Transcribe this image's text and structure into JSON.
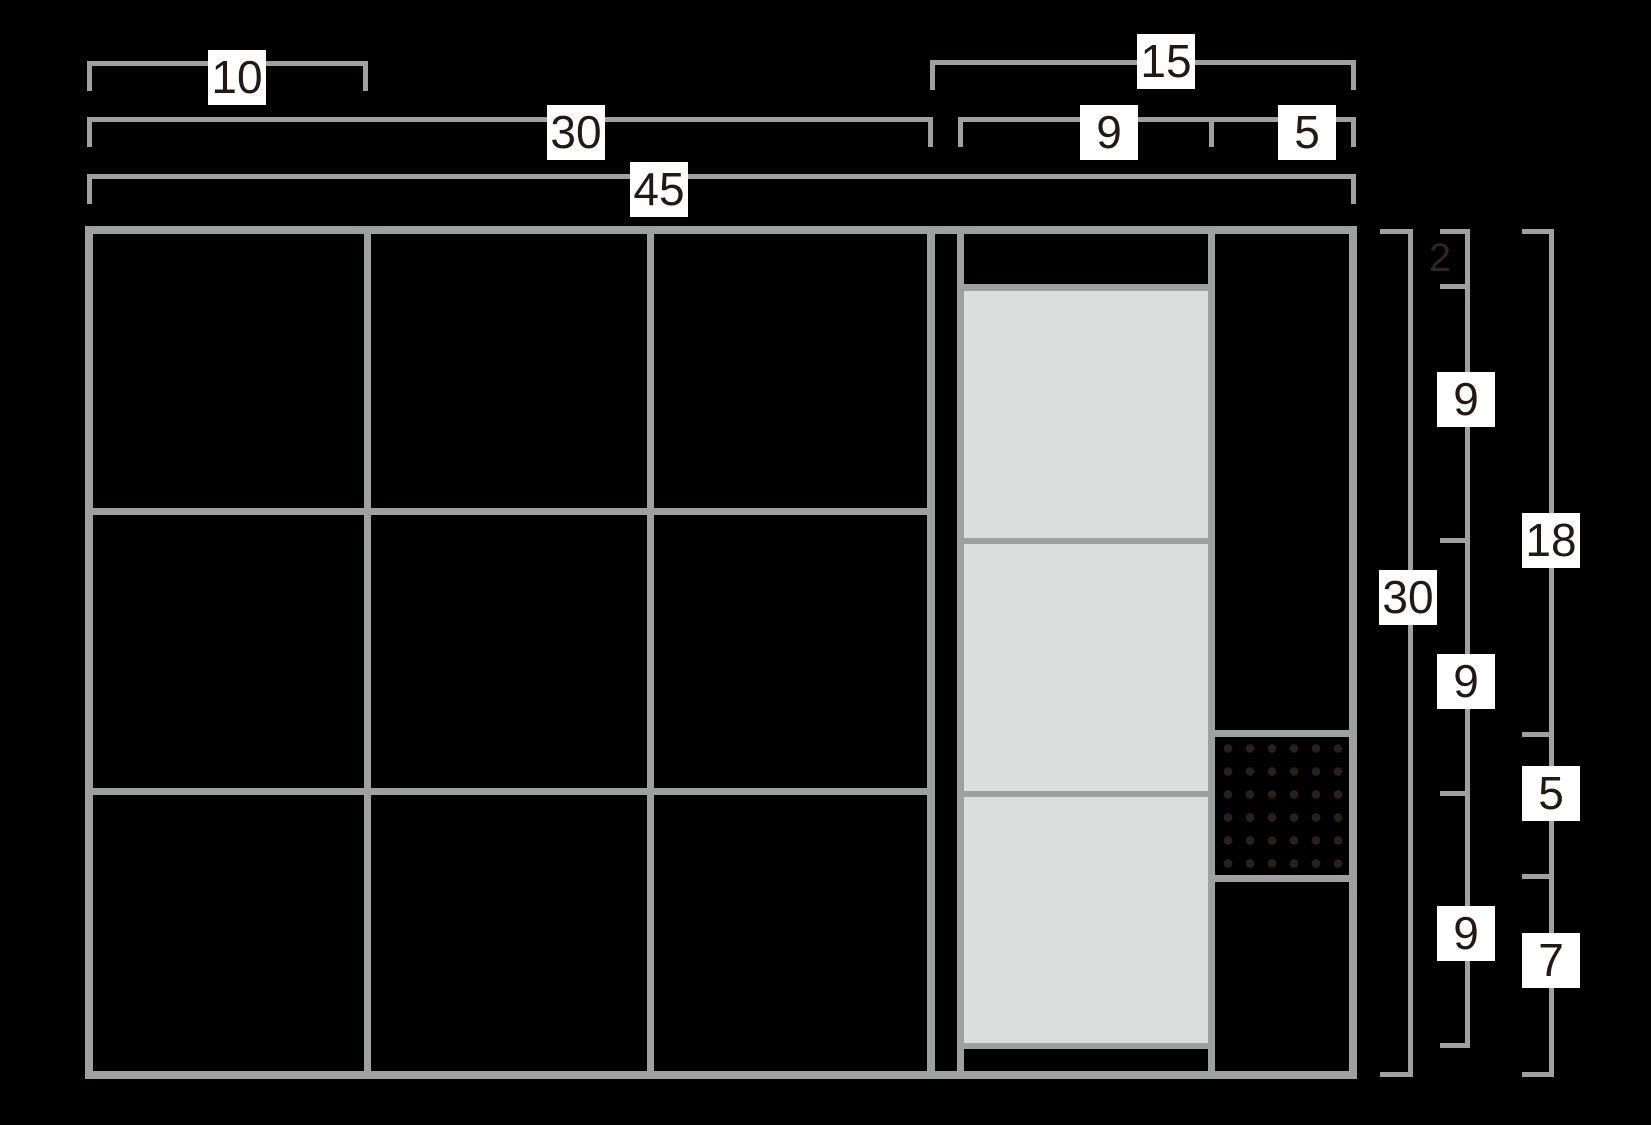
{
  "diagram": {
    "kind": "dimensioned elevation drawing",
    "colors": {
      "background": "#000000",
      "line": "#9fa0a0",
      "panel": "#dcdddd",
      "dot": "#2b1f1b",
      "label_bg": "#ffffff",
      "label_text": "#231815",
      "dim2_text": "#32241e"
    },
    "features": {
      "left_section_grid": "3x3 open bays",
      "panel_count": 3,
      "vent_dot_grid": "6x6"
    }
  },
  "dimensions": {
    "top_row": [
      {
        "name": "bay-width",
        "value": "10"
      },
      {
        "name": "left-section-width",
        "value": "30"
      },
      {
        "name": "overall-width",
        "value": "45"
      },
      {
        "name": "right-section-width",
        "value": "15"
      },
      {
        "name": "panel-bay-width",
        "value": "9"
      },
      {
        "name": "side-bay-width",
        "value": "5"
      }
    ],
    "right_col": [
      {
        "name": "overall-height",
        "value": "30"
      },
      {
        "name": "top-rail-height",
        "value": "2"
      },
      {
        "name": "panel-height-a",
        "value": "9"
      },
      {
        "name": "panel-height-b",
        "value": "9"
      },
      {
        "name": "panel-height-c",
        "value": "9"
      },
      {
        "name": "upper-side-height",
        "value": "18"
      },
      {
        "name": "vent-height",
        "value": "5"
      },
      {
        "name": "lower-side-height",
        "value": "7"
      }
    ]
  }
}
